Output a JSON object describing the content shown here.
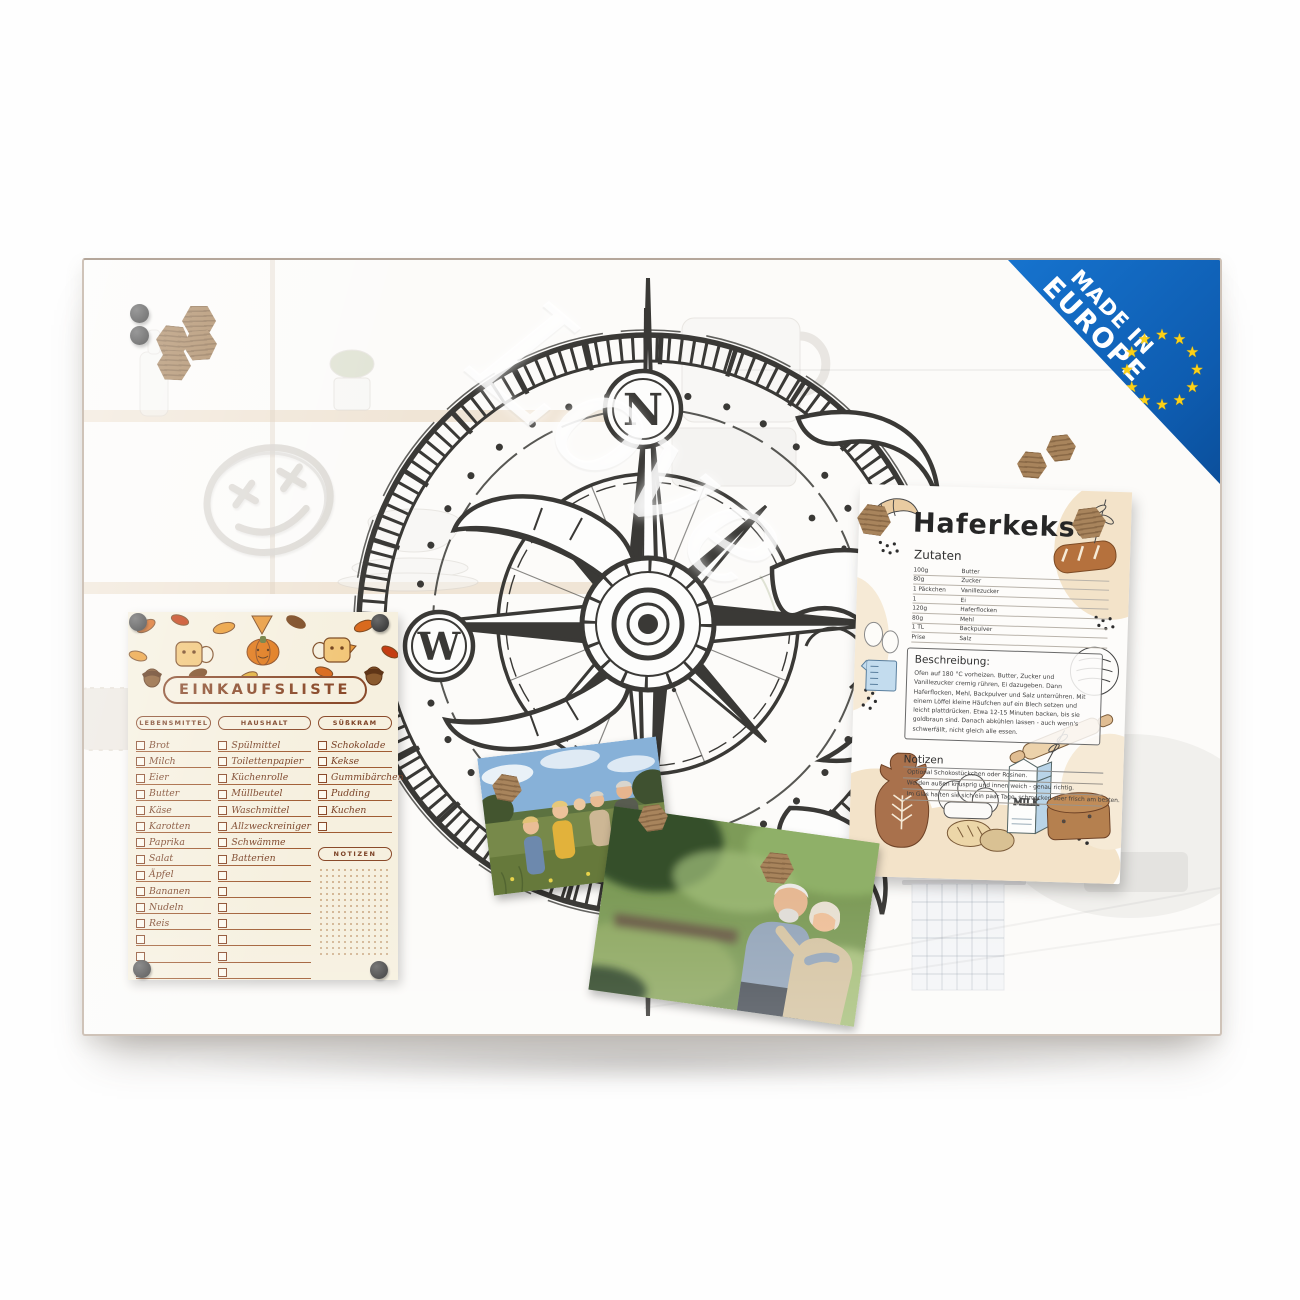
{
  "board": {
    "badge": {
      "line1": "MADE IN",
      "line2": "EUROPE",
      "star": "★",
      "blue": "#1065bd",
      "star_color": "#fdd116"
    },
    "compass": {
      "north_label": "N",
      "west_label": "W"
    },
    "watermark": "Love"
  },
  "shopping_list": {
    "title": "EINKAUFSLISTE",
    "notes_label": "NOTIZEN",
    "columns": [
      {
        "header": "LEBENSMITTEL",
        "items": [
          "Brot",
          "Milch",
          "Eier",
          "Butter",
          "Käse",
          "Karotten",
          "Paprika",
          "Salat",
          "Äpfel",
          "Bananen",
          "Nudeln",
          "Reis"
        ]
      },
      {
        "header": "HAUSHALT",
        "items": [
          "Spülmittel",
          "Toilettenpapier",
          "Küchenrolle",
          "Müllbeutel",
          "Waschmittel",
          "Allzweckreiniger",
          "Schwämme",
          "Batterien"
        ]
      },
      {
        "header": "SÜßKRAM",
        "items": [
          "Schokolade",
          "Kekse",
          "Gummibärchen",
          "Pudding",
          "Kuchen"
        ]
      }
    ]
  },
  "recipe": {
    "title": "Haferkekse",
    "ingredients_label": "Zutaten",
    "ingredients": [
      {
        "amount": "100g",
        "name": "Butter"
      },
      {
        "amount": "80g",
        "name": "Zucker"
      },
      {
        "amount": "1 Päckchen",
        "name": "Vanillezucker"
      },
      {
        "amount": "1",
        "name": "Ei"
      },
      {
        "amount": "120g",
        "name": "Haferflocken"
      },
      {
        "amount": "80g",
        "name": "Mehl"
      },
      {
        "amount": "1 TL",
        "name": "Backpulver"
      },
      {
        "amount": "Prise",
        "name": "Salz"
      }
    ],
    "description_label": "Beschreibung:",
    "description": "Ofen auf 180 °C vorheizen. Butter, Zucker und Vanillezucker cremig rühren, Ei dazugeben. Dann Haferflocken, Mehl, Backpulver und Salz unterrühren. Mit einem Löffel kleine Häufchen auf ein Blech setzen und leicht plattdrücken. Etwa 12-15 Minuten backen, bis sie goldbraun sind. Danach abkühlen lassen - auch wenn's schwerfällt, nicht gleich alle essen.",
    "notes_label": "Notizen",
    "notes": [
      "Optional Schokostückchen oder Rosinen.",
      "Werden außen knusprig und innen weich - genau richtig.",
      "Im Glas halten sie sich ein paar Tage, schmecken aber frisch am besten."
    ],
    "milk_label": "MILK"
  }
}
